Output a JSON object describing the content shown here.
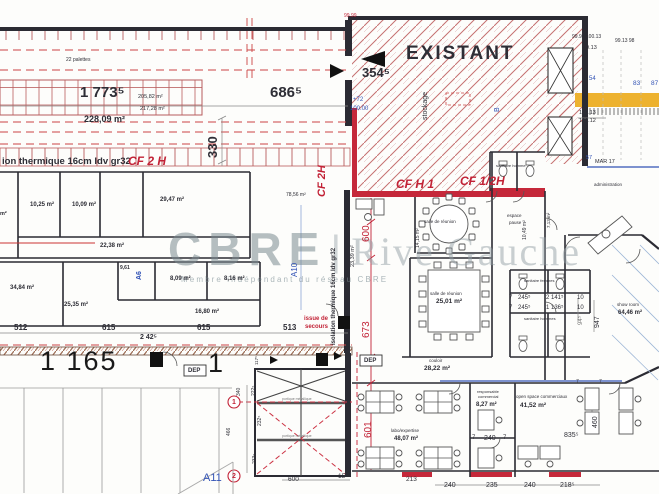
{
  "watermark": {
    "brand": "CBRE",
    "sep": "|",
    "suite": "Rive Gauche",
    "tagline": "Membre indépendant du réseau CBRE"
  },
  "warehouse": {
    "palettes": "22 palettes",
    "dim_main": "1 773⁵",
    "area_a": "205,82 m²",
    "area_b": "217,28 m²",
    "area_total": "228,09 m²",
    "dim_686": "686⁵",
    "dim_330": "330",
    "insulation": "ion thermique  16cm ldv gr32",
    "cf_2h": "CF 2 H",
    "elev_top": "99.99",
    "d512": "512",
    "d615a": "615",
    "d615b": "615",
    "d513": "513",
    "d2425": "2 42⁵",
    "d1165": "1 165",
    "bay_no": "1",
    "dep": "DEP"
  },
  "existant": {
    "title": "EXISTANT",
    "dim_354": "354⁵",
    "stockage": "stockage",
    "axis_b": "B",
    "level_plus": "+72",
    "level_val": "100.00"
  },
  "survey": {
    "row1": "99.99 100.13",
    "row2": "99.13 98",
    "e9913": "99.13",
    "n54": "54",
    "n83": "83",
    "n87": "87",
    "e10013": "100.13",
    "e10012": "100.12",
    "n57": "57",
    "mar": "MAR 17"
  },
  "fire": {
    "h1": "CF H 1",
    "half_h": "CF 1/2H",
    "v2h": "CF 2H",
    "iso_v": "isolation thermique  16cm ldv gr32"
  },
  "areas": {
    "r1025": "10,25 m²",
    "r1009": "10,09 m²",
    "r2947": "29,47 m²",
    "r2238": "22,38 m²",
    "r3484": "34,84 m²",
    "r2535": "25,35 m²",
    "r961": "9,61",
    "r809": "8,09 m²",
    "r816": "8,16 m²",
    "r1680": "16,80 m²",
    "r7856": "78,56 m²",
    "r2339": "23,39 m²",
    "r1415": "14,15 m²",
    "r1049": "10,49 m²",
    "r2501": "25,01 m²",
    "r2822": "28,22 m²",
    "r827": "8,27 m²",
    "r4152": "41,52 m²",
    "r4807": "48,07 m²",
    "r6446": "64,46 m²",
    "r713": "7,13 m²",
    "partial": "m²"
  },
  "names": {
    "salle_a": "salle de réunion",
    "salle_b": "salle de réunion",
    "pause_l1": "espace",
    "pause_l2": "pause",
    "couloir": "couloir",
    "show": "show room",
    "open": "open space commerciaux",
    "resp_l1": "responsable",
    "resp_l2": "commercial",
    "labo": "labo/expertise",
    "san_top": "sanitaire homme",
    "san_f": "sanitaire femmes",
    "san_h": "sanitaire hommes",
    "admin": "administration",
    "issue_l1": "issue de",
    "issue_l2": "secours",
    "portique": "portique métallique"
  },
  "axes": {
    "c1": "1",
    "c2": "2",
    "a6": "A6",
    "a10": "A10",
    "a11": "A11"
  },
  "dims": {
    "c600": "600",
    "c673": "673",
    "c601": "601",
    "d245a": "245⁵",
    "d2141": "2 141⁵",
    "d245b": "245⁵",
    "d1136": "1 136⁵",
    "n10a": "10",
    "n10b": "10",
    "n7a": "7",
    "n7b": "7",
    "d947": "947",
    "d94": "94⁵",
    "d460": "460",
    "d835": "835⁵",
    "d240m": "240",
    "n7c": "7",
    "n7d": "7",
    "b240a": "240",
    "b235": "235",
    "b240b": "240",
    "b218": "218⁵",
    "s600": "600",
    "s15": "15⁵",
    "s213": "213",
    "s340": "340",
    "s222": "222⁵",
    "s232": "232⁵",
    "s233": "233⁵",
    "s466": "466",
    "s117": "117⁵",
    "dep2": "DEP",
    "n7e": "7",
    "n7f": "7"
  }
}
